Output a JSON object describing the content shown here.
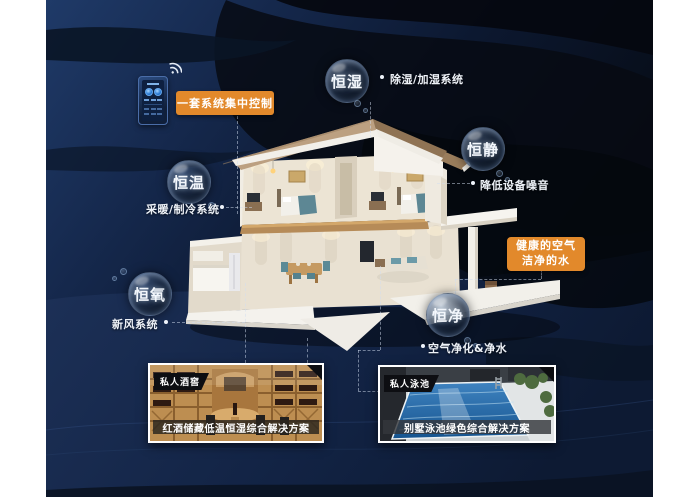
{
  "scene": {
    "control_panel_label": "一套系统集中控制",
    "highlight_line1": "健康的空气",
    "highlight_line2": "洁净的水"
  },
  "bubbles": {
    "humidity": {
      "label": "恒湿",
      "note": "除湿/加湿系统"
    },
    "quiet": {
      "label": "恒静",
      "note": "降低设备噪音"
    },
    "temperature": {
      "label": "恒温",
      "note": "采暖/制冷系统"
    },
    "oxygen": {
      "label": "恒氧",
      "note": "新风系统"
    },
    "purity": {
      "label": "恒净",
      "note": "空气净化&净水"
    }
  },
  "cards": {
    "wine_cellar": {
      "tag": "私人酒窖",
      "caption": "红酒储藏低温恒湿综合解决方案"
    },
    "pool": {
      "tag": "私人泳池",
      "caption": "别墅泳池绿色综合解决方案"
    }
  },
  "colors": {
    "accent_orange": "#e2892b",
    "background_navy": "#16294d",
    "background_dark": "#070c15"
  }
}
